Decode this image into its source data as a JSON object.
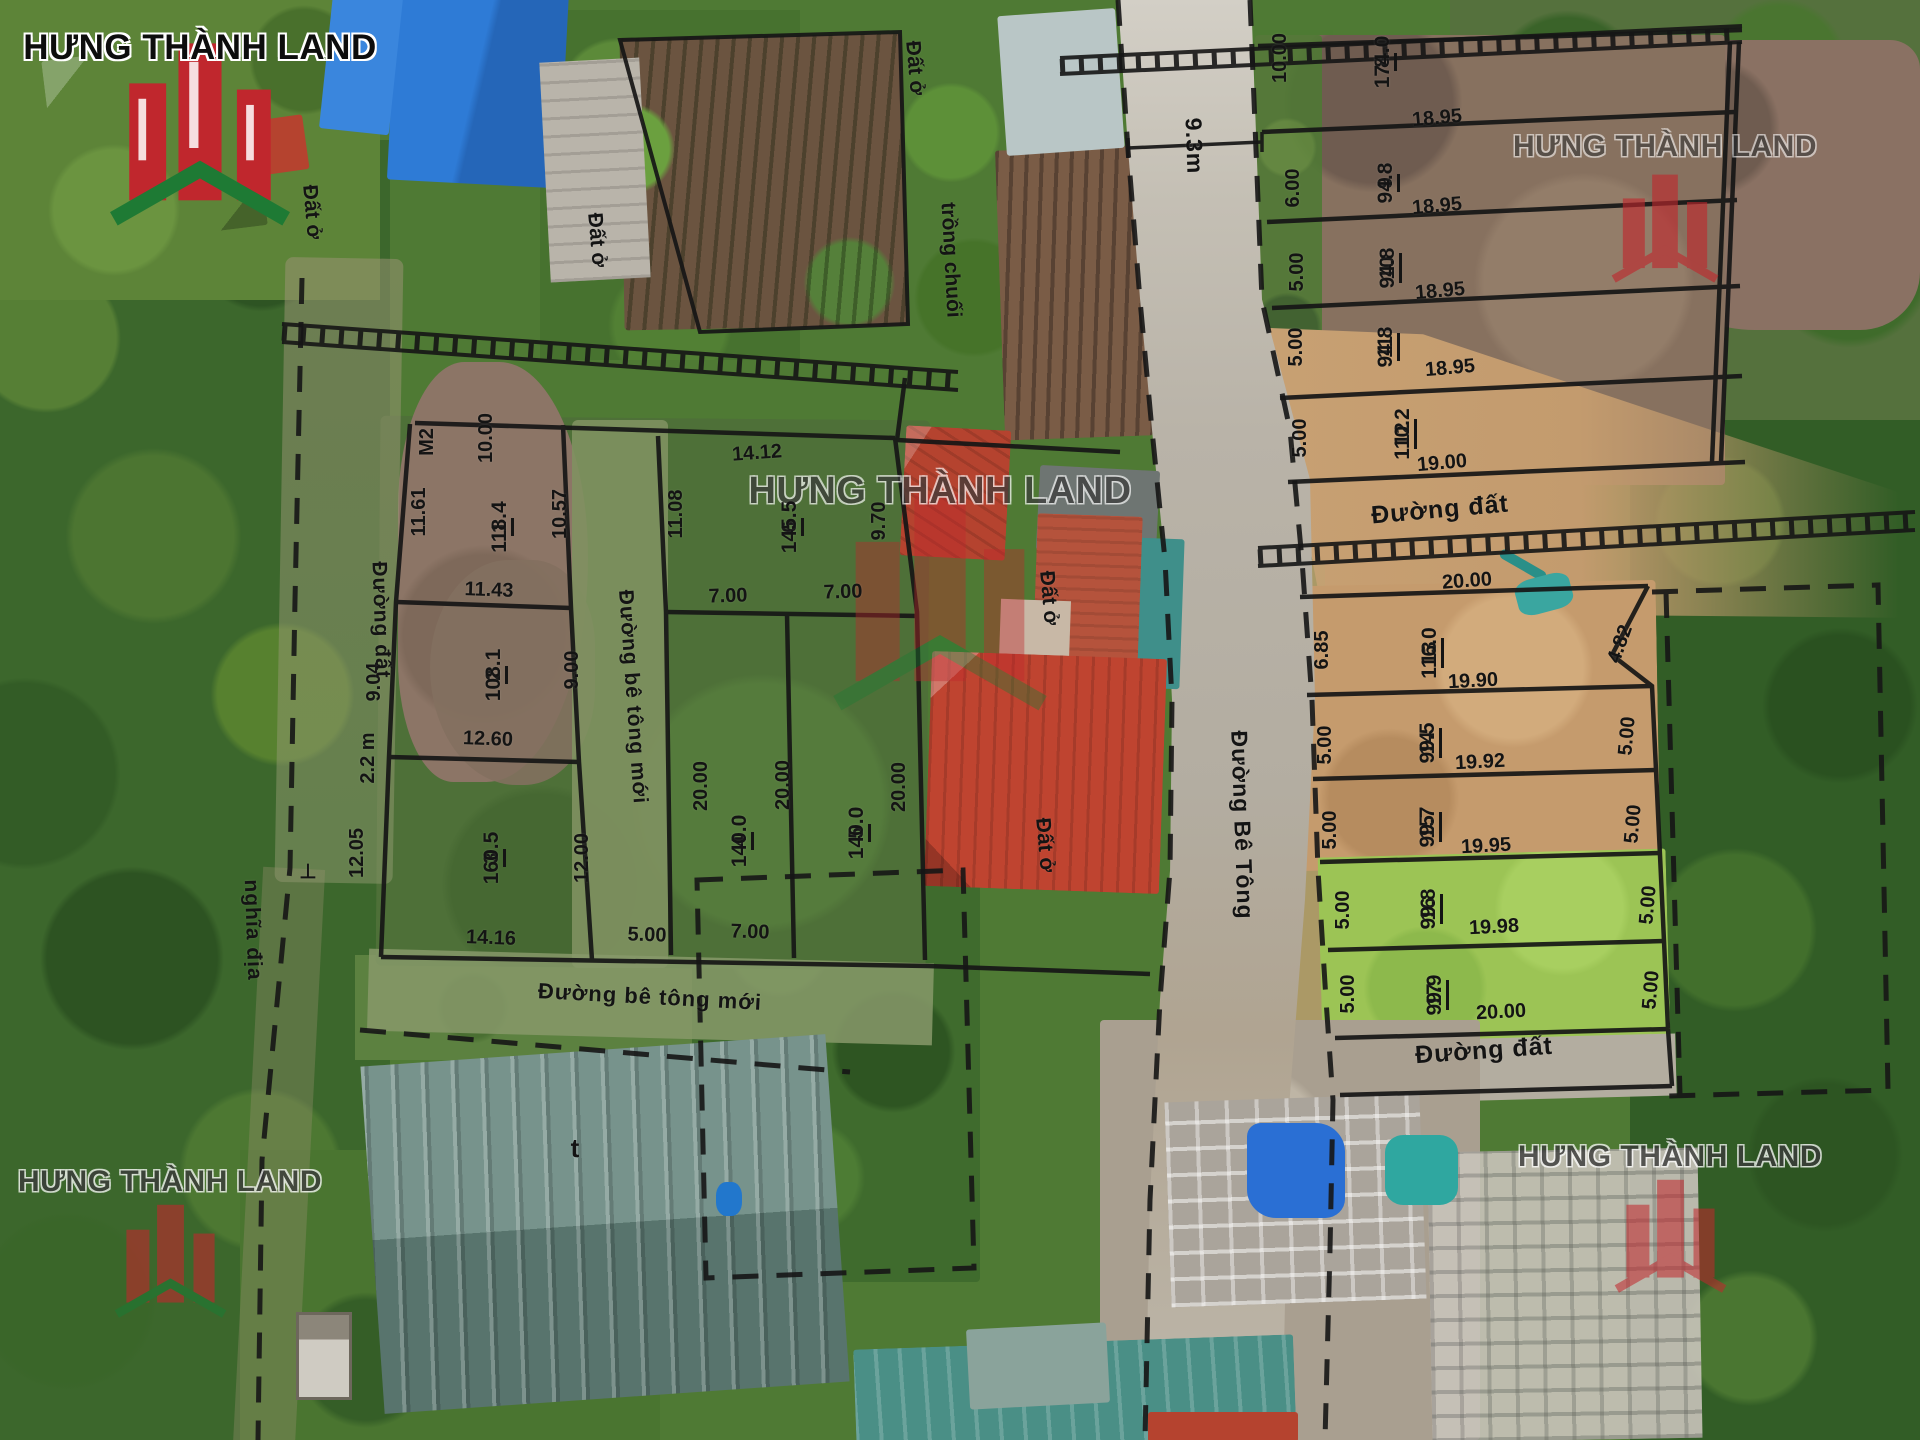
{
  "brand": {
    "name": "HƯNG THÀNH LAND",
    "logo_red": "#c0272d",
    "logo_green": "#1e7a34",
    "line_color": "#161616"
  },
  "map": {
    "road_names": [
      "Đường Bê Tông",
      "Đường đất",
      "Đường bê tông mới"
    ],
    "road_width_note": "9.3m",
    "land_use_notes": [
      "Đất ở",
      "trồng chuối",
      "nghĩa địa",
      "M2"
    ],
    "plots": [
      {
        "id": "1",
        "area": "118.4",
        "block": "west",
        "dims": [
          "10.00",
          "11.61",
          "10.57",
          "11.43"
        ]
      },
      {
        "id": "2",
        "area": "108.1",
        "block": "west",
        "dims": [
          "9.04",
          "9.00",
          "12.60"
        ]
      },
      {
        "id": "3",
        "area": "160.5",
        "block": "west",
        "dims": [
          "12.05",
          "12.00",
          "14.16"
        ]
      },
      {
        "id": "4",
        "area": "140.0",
        "block": "west",
        "dims": [
          "20.00",
          "7.00",
          "5.00"
        ]
      },
      {
        "id": "5",
        "area": "140.0",
        "block": "west",
        "dims": [
          "20.00",
          "7.00"
        ]
      },
      {
        "id": "6",
        "area": "145.5",
        "block": "west",
        "dims": [
          "14.12",
          "11.08",
          "9.70",
          "7.00",
          "7.00"
        ]
      },
      {
        "id": "8",
        "area": "174.0",
        "block": "northeast",
        "dims": [
          "10.00"
        ]
      },
      {
        "id": "9",
        "area": "94.8",
        "block": "northeast",
        "dims": [
          "18.95",
          "6.00"
        ]
      },
      {
        "id": "10",
        "area": "94.8",
        "block": "northeast",
        "dims": [
          "18.95",
          "5.00"
        ]
      },
      {
        "id": "11",
        "area": "94.8",
        "block": "northeast",
        "dims": [
          "18.95",
          "5.00"
        ]
      },
      {
        "id": "12",
        "area": "110.2",
        "block": "northeast",
        "dims": [
          "18.95",
          "19.00",
          "5.00"
        ]
      },
      {
        "id": "13",
        "area": "116.0",
        "block": "southeast",
        "dims": [
          "20.00",
          "19.90",
          "6.85",
          "4.82"
        ]
      },
      {
        "id": "14",
        "area": "99.5",
        "block": "southeast",
        "dims": [
          "19.90",
          "19.92",
          "5.00",
          "5.00"
        ]
      },
      {
        "id": "15",
        "area": "99.7",
        "block": "southeast",
        "dims": [
          "19.92",
          "19.95",
          "5.00",
          "5.00"
        ]
      },
      {
        "id": "16",
        "area": "99.8",
        "block": "southeast",
        "dims": [
          "19.95",
          "19.98",
          "5.00",
          "5.00"
        ]
      },
      {
        "id": "17",
        "area": "99.9",
        "block": "southeast",
        "dims": [
          "19.98",
          "20.00",
          "5.00",
          "5.00"
        ]
      }
    ],
    "labels": {
      "fractions": [
        {
          "num": "1",
          "den": "118.4",
          "x": 489,
          "y": 527
        },
        {
          "num": "2",
          "den": "108.1",
          "x": 483,
          "y": 675
        },
        {
          "num": "3",
          "den": "160.5",
          "x": 481,
          "y": 858
        },
        {
          "num": "4",
          "den": "140.0",
          "x": 729,
          "y": 841
        },
        {
          "num": "5",
          "den": "140.0",
          "x": 846,
          "y": 833
        },
        {
          "num": "6",
          "den": "145.5",
          "x": 779,
          "y": 527
        },
        {
          "num": "8",
          "den": "174.0",
          "x": 1372,
          "y": 62
        },
        {
          "num": "9",
          "den": "94.8",
          "x": 1375,
          "y": 183
        },
        {
          "num": "10",
          "den": "94.8",
          "x": 1377,
          "y": 268
        },
        {
          "num": "11",
          "den": "94.8",
          "x": 1375,
          "y": 347
        },
        {
          "num": "12",
          "den": "110.2",
          "x": 1392,
          "y": 434
        },
        {
          "num": "13",
          "den": "116.0",
          "x": 1419,
          "y": 653
        },
        {
          "num": "14",
          "den": "99.5",
          "x": 1417,
          "y": 743
        },
        {
          "num": "15",
          "den": "99.7",
          "x": 1417,
          "y": 827
        },
        {
          "num": "16",
          "den": "99.8",
          "x": 1418,
          "y": 909
        },
        {
          "num": "17",
          "den": "99.9",
          "x": 1424,
          "y": 995
        }
      ],
      "dims_vertical": [
        {
          "text": "M2",
          "x": 427,
          "y": 442
        },
        {
          "text": "11.61",
          "x": 419,
          "y": 512
        },
        {
          "text": "10.00",
          "x": 486,
          "y": 438
        },
        {
          "text": "10.57",
          "x": 560,
          "y": 514
        },
        {
          "text": "9.04",
          "x": 374,
          "y": 682
        },
        {
          "text": "9.00",
          "x": 572,
          "y": 670
        },
        {
          "text": "2.2 m",
          "x": 368,
          "y": 758
        },
        {
          "text": "12.05",
          "x": 357,
          "y": 853
        },
        {
          "text": "12.00",
          "x": 582,
          "y": 858
        },
        {
          "text": "20.00",
          "x": 701,
          "y": 786
        },
        {
          "text": "20.00",
          "x": 783,
          "y": 785
        },
        {
          "text": "20.00",
          "x": 899,
          "y": 787
        },
        {
          "text": "11.08",
          "x": 676,
          "y": 514
        },
        {
          "text": "9.70",
          "x": 879,
          "y": 521
        },
        {
          "text": "10.00",
          "x": 1280,
          "y": 58
        },
        {
          "text": "6.00",
          "x": 1293,
          "y": 188
        },
        {
          "text": "5.00",
          "x": 1297,
          "y": 272
        },
        {
          "text": "5.00",
          "x": 1296,
          "y": 347
        },
        {
          "text": "5.00",
          "x": 1300,
          "y": 438
        },
        {
          "text": "6.85",
          "x": 1322,
          "y": 650
        },
        {
          "text": "5.00",
          "x": 1325,
          "y": 745
        },
        {
          "text": "5.00",
          "x": 1330,
          "y": 830
        },
        {
          "text": "5.00",
          "x": 1343,
          "y": 910
        },
        {
          "text": "5.00",
          "x": 1348,
          "y": 994
        },
        {
          "text": "4.82",
          "x": 1620,
          "y": 644,
          "rot": -70
        },
        {
          "text": "5.00",
          "x": 1627,
          "y": 736,
          "rot": -85
        },
        {
          "text": "5.00",
          "x": 1633,
          "y": 824,
          "rot": -85
        },
        {
          "text": "5.00",
          "x": 1648,
          "y": 905,
          "rot": -85
        },
        {
          "text": "5.00",
          "x": 1651,
          "y": 990,
          "rot": -85
        }
      ],
      "dims_horizontal": [
        {
          "text": "14.12",
          "x": 757,
          "y": 453,
          "rot": -4
        },
        {
          "text": "11.43",
          "x": 489,
          "y": 590,
          "rot": 2
        },
        {
          "text": "12.60",
          "x": 488,
          "y": 739,
          "rot": 2
        },
        {
          "text": "14.16",
          "x": 491,
          "y": 938,
          "rot": 2
        },
        {
          "text": "5.00",
          "x": 647,
          "y": 935,
          "rot": 2
        },
        {
          "text": "7.00",
          "x": 750,
          "y": 932,
          "rot": 2
        },
        {
          "text": "7.00",
          "x": 728,
          "y": 596,
          "rot": -2
        },
        {
          "text": "7.00",
          "x": 843,
          "y": 592,
          "rot": -2
        },
        {
          "text": "18.95",
          "x": 1437,
          "y": 118,
          "rot": -5
        },
        {
          "text": "18.95",
          "x": 1437,
          "y": 206,
          "rot": -5
        },
        {
          "text": "18.95",
          "x": 1440,
          "y": 291,
          "rot": -5
        },
        {
          "text": "18.95",
          "x": 1450,
          "y": 368,
          "rot": -5
        },
        {
          "text": "19.00",
          "x": 1442,
          "y": 463,
          "rot": -5
        },
        {
          "text": "20.00",
          "x": 1467,
          "y": 581,
          "rot": -4
        },
        {
          "text": "19.90",
          "x": 1473,
          "y": 681,
          "rot": -3
        },
        {
          "text": "19.92",
          "x": 1480,
          "y": 762,
          "rot": -3
        },
        {
          "text": "19.95",
          "x": 1486,
          "y": 846,
          "rot": -3
        },
        {
          "text": "19.98",
          "x": 1494,
          "y": 927,
          "rot": -3
        },
        {
          "text": "20.00",
          "x": 1501,
          "y": 1012,
          "rot": -3
        },
        {
          "text": "⊥",
          "x": 308,
          "y": 872,
          "rot": 0
        },
        {
          "text": "t",
          "x": 575,
          "y": 1148,
          "rot": 0,
          "size": 26
        }
      ],
      "roads": [
        {
          "text": "Đường đất",
          "x": 381,
          "y": 620,
          "rot": 88,
          "size": 21
        },
        {
          "text": "Đường bê tông mới",
          "x": 633,
          "y": 697,
          "rot": 86,
          "size": 21
        },
        {
          "text": "Đường bê tông mới",
          "x": 650,
          "y": 997,
          "rot": 3,
          "size": 22
        },
        {
          "text": "nghĩa địa",
          "x": 253,
          "y": 930,
          "rot": 88,
          "size": 21
        },
        {
          "text": "Đường Bê Tông",
          "x": 1242,
          "y": 825,
          "rot": 88,
          "size": 23
        },
        {
          "text": "Đường đất",
          "x": 1440,
          "y": 510,
          "rot": -5,
          "size": 25
        },
        {
          "text": "Đường đất",
          "x": 1484,
          "y": 1051,
          "rot": -4,
          "size": 25
        },
        {
          "text": "9.3m",
          "x": 1194,
          "y": 146,
          "rot": 88,
          "size": 23
        }
      ],
      "land_use": [
        {
          "text": "Đất ở",
          "x": 312,
          "y": 212,
          "rot": 85
        },
        {
          "text": "Đất ở",
          "x": 597,
          "y": 240,
          "rot": 85
        },
        {
          "text": "Đất ở",
          "x": 915,
          "y": 68,
          "rot": 85
        },
        {
          "text": "trồng chuối",
          "x": 951,
          "y": 260,
          "rot": 87
        },
        {
          "text": "Đất ở",
          "x": 1049,
          "y": 598,
          "rot": 85
        },
        {
          "text": "Đất ở",
          "x": 1045,
          "y": 845,
          "rot": 85
        }
      ]
    }
  }
}
